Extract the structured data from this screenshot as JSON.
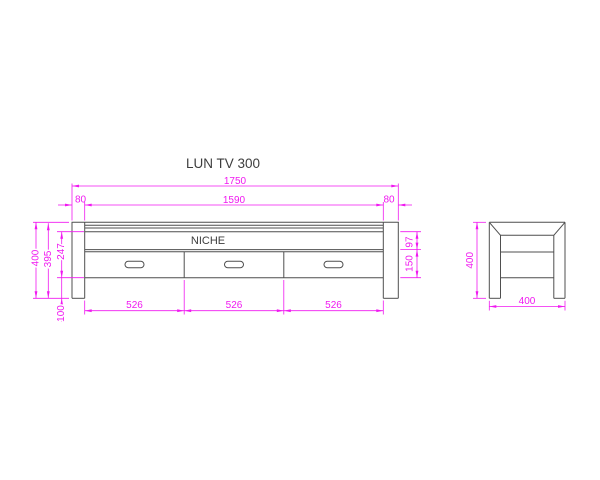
{
  "drawing": {
    "title": "LUN TV 300",
    "niche_label": "NICHE",
    "colors": {
      "dimension": "#f018f0",
      "object_line": "#4f4f4f",
      "text": "#3d3d3d",
      "background": "#ffffff"
    },
    "front": {
      "total_width": "1750",
      "opening_width": "1590",
      "left_side_thickness": "80",
      "right_side_thickness": "80",
      "total_height": "400",
      "body_height": "395",
      "opening_height": "247",
      "base_clearance": "100",
      "niche_height": "97",
      "drawer_height": "150",
      "drawer_width_1": "526",
      "drawer_width_2": "526",
      "drawer_width_3": "526"
    },
    "side": {
      "height": "400",
      "depth": "400"
    }
  }
}
